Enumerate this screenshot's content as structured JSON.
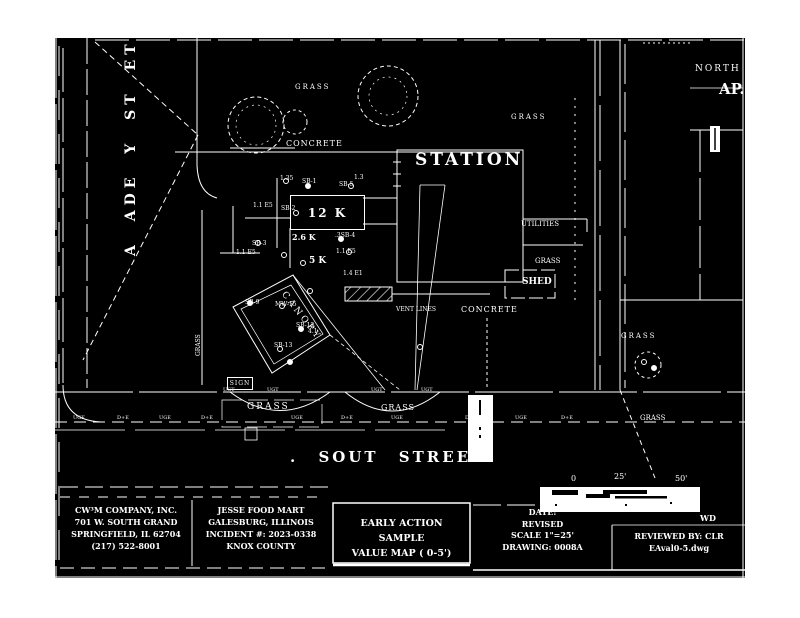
{
  "compass": {
    "north_label": "NORTH",
    "corner_text": "AP."
  },
  "streets": {
    "academy_label": "A ADE Y ST ET",
    "south_label": ". SOUT   STREET"
  },
  "area_labels": {
    "grass_nw": "GRASS",
    "concrete_nw": "CONCRETE",
    "station": "STATION",
    "grass_ne": "GRASS",
    "utilities": "UTILITIES",
    "grass_e": "GRASS",
    "shed": "SHED",
    "grass_right": "GRASS",
    "grass_sw": "GRASS",
    "grass_s": "GRASS",
    "grass_se": "GRASS",
    "grass_w_vertical": "GRASS",
    "concrete_s": "CONCRETE",
    "vent_lines": "VENT LINES",
    "canopy": "CANOPY",
    "sign": "SIGN"
  },
  "samples": {
    "sb1": "SB-1",
    "sb1_value": "1.35",
    "sb5": "SB-5",
    "sb5_value": "1.3",
    "sb2": "SB-2",
    "sb2_value": "1.1 E5",
    "sb3": "SB-3",
    "sb3_value": "1.1 E5",
    "sb4": ".3SB-4",
    "sb4_value": "1.1 E5",
    "kiosk_value": "12 K",
    "island_value": "2.6 K",
    "pump_value": "5 K",
    "value_14": "1.4 E1",
    "sb9": "SB-9",
    "mw15": "MW-15",
    "sb12": "SB-12",
    "sb12_value": "4.1",
    "sb13": "SB-13"
  },
  "utility_tags_lower": [
    "UGE",
    "D+E",
    "UGE",
    "D+E",
    "UGE",
    "D+E",
    "UGE",
    "D+E",
    "UGE",
    "D+E"
  ],
  "utility_tags_upper": [
    "UGT",
    "UGT",
    "UGT",
    "UGT"
  ],
  "scalebar": {
    "tick_0": "0",
    "tick_25": "25'",
    "tick_50": "50'"
  },
  "titleblock": {
    "company": {
      "line1": "CW³M COMPANY, INC.",
      "line2": "701 W. SOUTH GRAND",
      "line3": "SPRINGFIELD, IL 62704",
      "line4": "(217) 522-8001"
    },
    "site": {
      "line1": "JESSE FOOD MART",
      "line2": "GALESBURG, ILLINOIS",
      "line3": "INCIDENT #: 2023-0338",
      "line4": "KNOX COUNTY"
    },
    "map_title": {
      "line1": "EARLY ACTION SAMPLE",
      "line2": "VALUE MAP ( 0-5')"
    },
    "info": {
      "date": "DATE:",
      "revised": "REVISED",
      "scale": "SCALE 1\"=25'",
      "drawing": "DRAWING: 0008A",
      "fragment": "WD"
    },
    "review": {
      "reviewed_by": "REVIEWED BY: CLR",
      "file": "EAval0-5.dwg"
    }
  },
  "colors": {
    "paper": "#ffffff",
    "ink": "#000000",
    "linework": "#ffffff"
  }
}
